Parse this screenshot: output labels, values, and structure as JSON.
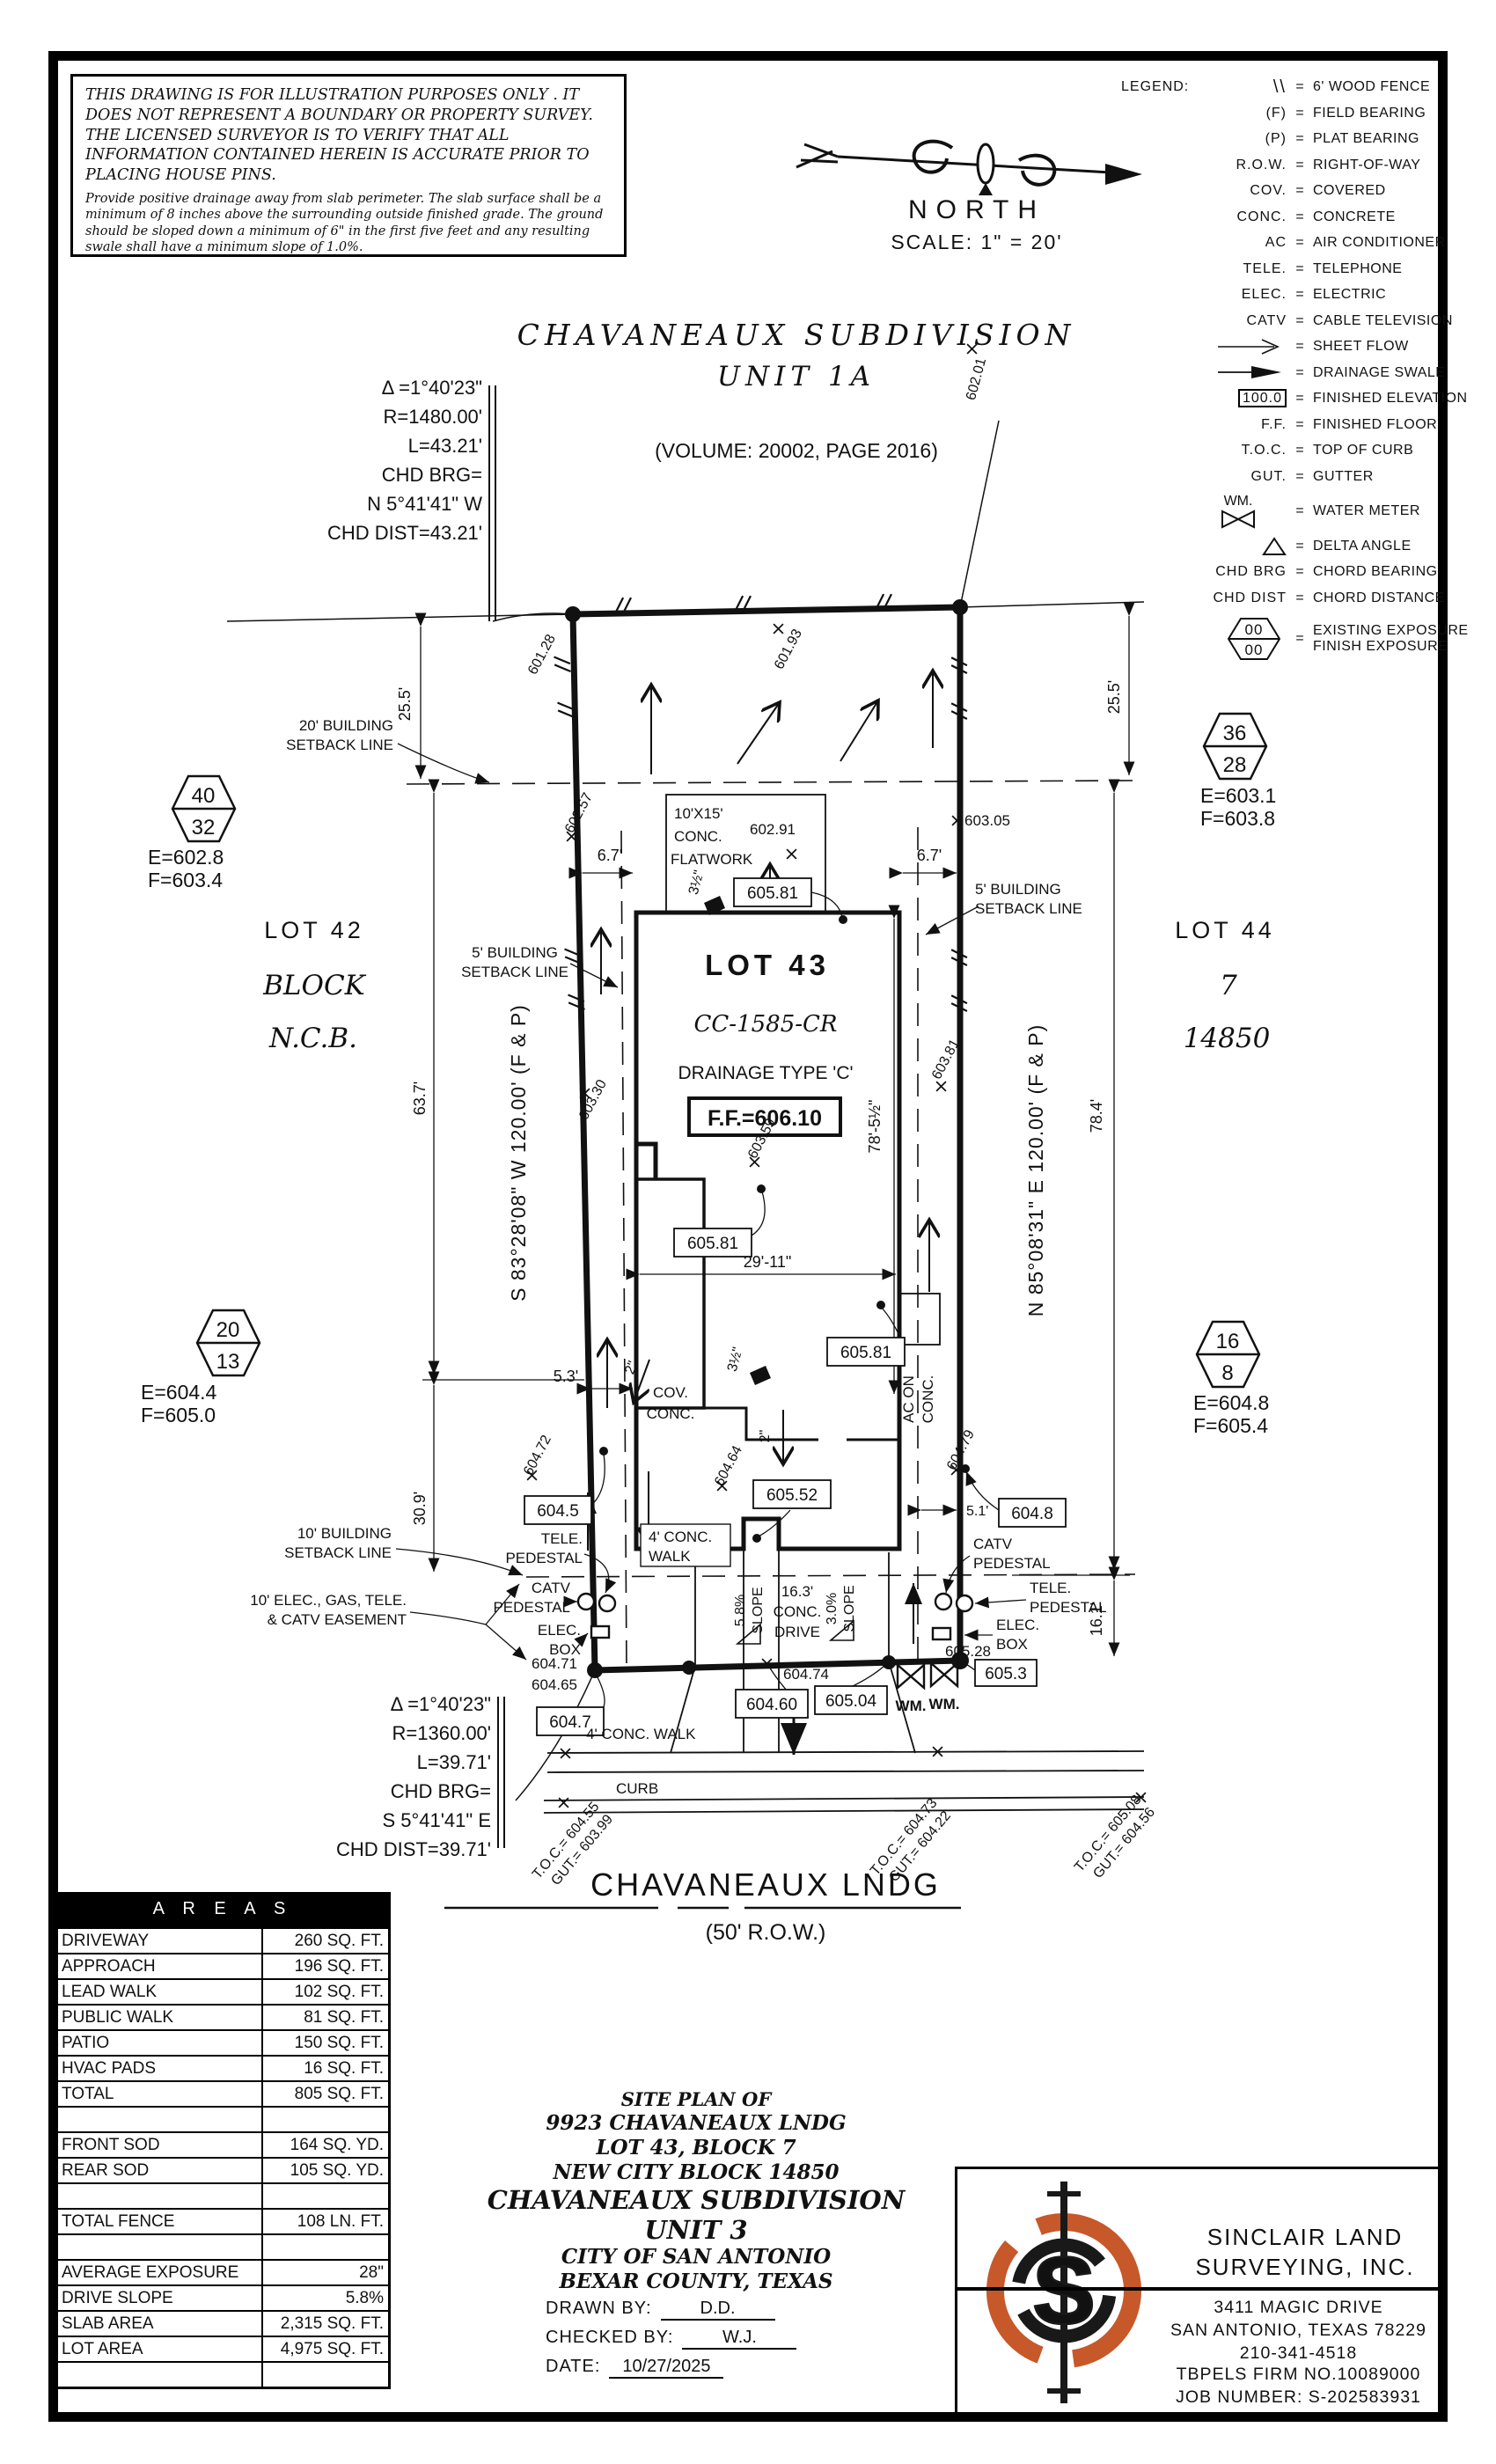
{
  "accent": "#c6582a",
  "disclaimer": {
    "para1": "THIS DRAWING IS FOR ILLUSTRATION PURPOSES ONLY . IT DOES NOT REPRESENT A BOUNDARY OR PROPERTY SURVEY. THE LICENSED SURVEYOR IS TO VERIFY THAT ALL INFORMATION CONTAINED HEREIN IS ACCURATE PRIOR TO PLACING HOUSE PINS.",
    "para2": "Provide positive drainage away from slab perimeter. The slab surface shall be a minimum of 8 inches above the surrounding outside finished grade. The ground should be sloped down a minimum of 6\" in the first five feet and any resulting swale shall have a minimum slope of 1.0%."
  },
  "compass": {
    "north": "NORTH",
    "scale": "SCALE:  1\" =  20'"
  },
  "legend": {
    "title": "LEGEND:",
    "eq": "=",
    "items": [
      {
        "sym": "\\\\",
        "desc": "6' WOOD FENCE"
      },
      {
        "sym": "(F)",
        "desc": "FIELD BEARING"
      },
      {
        "sym": "(P)",
        "desc": "PLAT BEARING"
      },
      {
        "sym": "R.O.W.",
        "desc": "RIGHT-OF-WAY"
      },
      {
        "sym": "COV.",
        "desc": "COVERED"
      },
      {
        "sym": "CONC.",
        "desc": "CONCRETE"
      },
      {
        "sym": "AC",
        "desc": "AIR CONDITIONER"
      },
      {
        "sym": "TELE.",
        "desc": "TELEPHONE"
      },
      {
        "sym": "ELEC.",
        "desc": "ELECTRIC"
      },
      {
        "sym": "CATV",
        "desc": "CABLE TELEVISION"
      },
      {
        "sym": "",
        "desc": "SHEET FLOW"
      },
      {
        "sym": "",
        "desc": "DRAINAGE SWALE"
      },
      {
        "sym": "100.0",
        "desc": "FINISHED ELEVATION"
      },
      {
        "sym": "F.F.",
        "desc": "FINISHED FLOOR"
      },
      {
        "sym": "T.O.C.",
        "desc": "TOP OF CURB"
      },
      {
        "sym": "GUT.",
        "desc": "GUTTER"
      },
      {
        "sym": "WM.",
        "desc": "WATER METER"
      },
      {
        "sym": "",
        "desc": "DELTA ANGLE"
      },
      {
        "sym": "CHD BRG",
        "desc": "CHORD BEARING"
      },
      {
        "sym": "CHD DIST",
        "desc": "CHORD DISTANCE"
      },
      {
        "sym_top": "00",
        "sym_bottom": "00",
        "desc1": "EXISTING EXPOSURE",
        "desc2": "FINISH EXPOSURE"
      }
    ]
  },
  "subdivision": {
    "title": "CHAVANEAUX SUBDIVISION",
    "unit": "UNIT 1A",
    "volume": "(VOLUME: 20002, PAGE 2016)"
  },
  "curve_top": {
    "delta": "Δ =1°40'23\"",
    "radius": "R=1480.00'",
    "arc": "L=43.21'",
    "chd_brg_label": "CHD BRG=",
    "chd_brg": "N 5°41'41\" W",
    "chd_dist": "CHD DIST=43.21'"
  },
  "curve_bottom": {
    "delta": "Δ =1°40'23\"",
    "radius": "R=1360.00'",
    "arc": "L=39.71'",
    "chd_brg_label": "CHD BRG=",
    "chd_brg": "S 5°41'41\" E",
    "chd_dist": "CHD DIST=39.71'"
  },
  "neighbors": {
    "lot_left": "LOT 42",
    "block_word": "BLOCK",
    "ncb_word": "N.C.B.",
    "lot_right": "LOT 44",
    "block_num": "7",
    "ncb_num": "14850"
  },
  "exposure": {
    "nw": {
      "top": "40",
      "bottom": "32",
      "e": "E=602.8",
      "f": "F=603.4"
    },
    "ne": {
      "top": "36",
      "bottom": "28",
      "e": "E=603.1",
      "f": "F=603.8"
    },
    "sw": {
      "top": "20",
      "bottom": "13",
      "e": "E=604.4",
      "f": "F=605.0"
    },
    "se": {
      "top": "16",
      "bottom": "8",
      "e": "E=604.8",
      "f": "F=605.4"
    }
  },
  "lot": {
    "name": "LOT 43",
    "code": "CC-1585-CR",
    "drainage": "DRAINAGE TYPE 'C'",
    "ff": "F.F.=606.10"
  },
  "bearings": {
    "west": "S 83°28'08\" W  120.00'  (F & P)",
    "east": "N 85°08'31\" E  120.00'  (F & P)"
  },
  "setbacks": {
    "b20_1": "20' BUILDING",
    "b20_2": "SETBACK LINE",
    "b5_1": "5' BUILDING",
    "b5_2": "SETBACK LINE",
    "b10_1": "10' BUILDING",
    "b10_2": "SETBACK LINE",
    "ease_1": "10' ELEC., GAS, TELE.",
    "ease_2": "& CATV EASEMENT"
  },
  "dims": {
    "left_front": "25.5'",
    "right_front": "25.5'",
    "left_a": "63.7'",
    "left_b": "30.9'",
    "right_a": "78.4'",
    "right_b": "16.1'",
    "house_l": "6.7'",
    "house_r": "6.7'",
    "porch": "5.3'",
    "ac": "5.1'",
    "width": "29'-11\"",
    "depth": "78'-5½\"",
    "t3a": "3½\"",
    "t3b": "3½\"",
    "t2a": "2\"",
    "t2b": "2\"",
    "t2c": "2\""
  },
  "spots": {
    "s60128": "601.28",
    "s60193": "601.93",
    "s60201": "602.01",
    "s60257": "602.57",
    "s60291": "602.91",
    "s60305": "603.05",
    "s60330": "603.30",
    "s60359": "603.59",
    "s60381": "603.81",
    "s60464": "604.64",
    "s60472": "604.72",
    "s60479": "604.79",
    "s60471": "604.71",
    "s60465": "604.65",
    "s60474": "604.74",
    "s60528": "605.28"
  },
  "boxed": {
    "b605811": "605.81",
    "b605812": "605.81",
    "b605813": "605.81",
    "b60552": "605.52",
    "b6045": "604.5",
    "b6047": "604.7",
    "b6048": "604.8",
    "b60460": "604.60",
    "b60504": "605.04",
    "b6053": "605.3"
  },
  "flatwork": {
    "l1": "10'X15'",
    "l2": "CONC.",
    "l3": "FLATWORK"
  },
  "features": {
    "cov1": "COV.",
    "cov2": "CONC.",
    "ac1": "AC ON",
    "ac2": "CONC.",
    "leadwalk1": "4' CONC.",
    "leadwalk2": "WALK",
    "publicwalk": "4' CONC. WALK",
    "curb": "CURB",
    "drive1": "16.3'",
    "drive2": "CONC.",
    "drive3": "DRIVE",
    "slope_l_pct": "5.8%",
    "slope_l_word": "SLOPE",
    "slope_r_pct": "3.0%",
    "slope_r_word": "SLOPE"
  },
  "utilities": {
    "tele1": "TELE.",
    "tele2": "PEDESTAL",
    "catv1": "CATV",
    "catv2": "PEDESTAL",
    "elec1": "ELEC.",
    "elec2": "BOX",
    "wm": "WM."
  },
  "street": {
    "name": "CHAVANEAUX LNDG",
    "row": "(50' R.O.W.)",
    "toc1": "T.O.C.= 604.55",
    "gut1": "GUT.= 603.99",
    "toc2": "T.O.C.= 604.73",
    "gut2": "GUT.= 604.22",
    "toc3": "T.O.C.= 605.08",
    "gut3": "GUT.= 604.56"
  },
  "areas": {
    "title": "A R E A S",
    "rows": [
      {
        "label": "DRIVEWAY",
        "value": "260 SQ. FT."
      },
      {
        "label": "APPROACH",
        "value": "196 SQ. FT."
      },
      {
        "label": "LEAD WALK",
        "value": "102 SQ. FT."
      },
      {
        "label": "PUBLIC WALK",
        "value": "81 SQ. FT."
      },
      {
        "label": "PATIO",
        "value": "150 SQ. FT."
      },
      {
        "label": "HVAC PADS",
        "value": "16 SQ. FT."
      },
      {
        "label": "TOTAL",
        "value": "805 SQ. FT."
      },
      {
        "label": "",
        "value": ""
      },
      {
        "label": "FRONT SOD",
        "value": "164 SQ. YD."
      },
      {
        "label": "REAR SOD",
        "value": "105 SQ. YD."
      },
      {
        "label": "",
        "value": ""
      },
      {
        "label": "TOTAL FENCE",
        "value": "108 LN. FT."
      },
      {
        "label": "",
        "value": ""
      },
      {
        "label": "AVERAGE EXPOSURE",
        "value": "28\""
      },
      {
        "label": "DRIVE SLOPE",
        "value": "5.8%"
      },
      {
        "label": "SLAB AREA",
        "value": "2,315 SQ. FT."
      },
      {
        "label": "LOT AREA",
        "value": "4,975 SQ. FT."
      },
      {
        "label": "",
        "value": ""
      }
    ]
  },
  "titleblock": {
    "l1": "SITE PLAN OF",
    "l2": "9923 CHAVANEAUX LNDG",
    "l3": "LOT 43, BLOCK 7",
    "l4": "NEW CITY BLOCK 14850",
    "l5": "CHAVANEAUX SUBDIVISION",
    "l6": "UNIT 3",
    "l7": "CITY OF SAN ANTONIO",
    "l8": "BEXAR COUNTY, TEXAS",
    "drawn_label": "DRAWN BY:",
    "drawn": "D.D.",
    "checked_label": "CHECKED BY:",
    "checked": "W.J.",
    "date_label": "DATE:",
    "date": "10/27/2025"
  },
  "firm": {
    "name1": "SINCLAIR LAND",
    "name2": "SURVEYING, INC.",
    "addr1": "3411 MAGIC DRIVE",
    "addr2": "SAN ANTONIO, TEXAS 78229",
    "phone": "210-341-4518",
    "tbpels": "TBPELS FIRM NO.10089000",
    "job": "JOB NUMBER: S-202583931",
    "logo_letter": "S"
  }
}
